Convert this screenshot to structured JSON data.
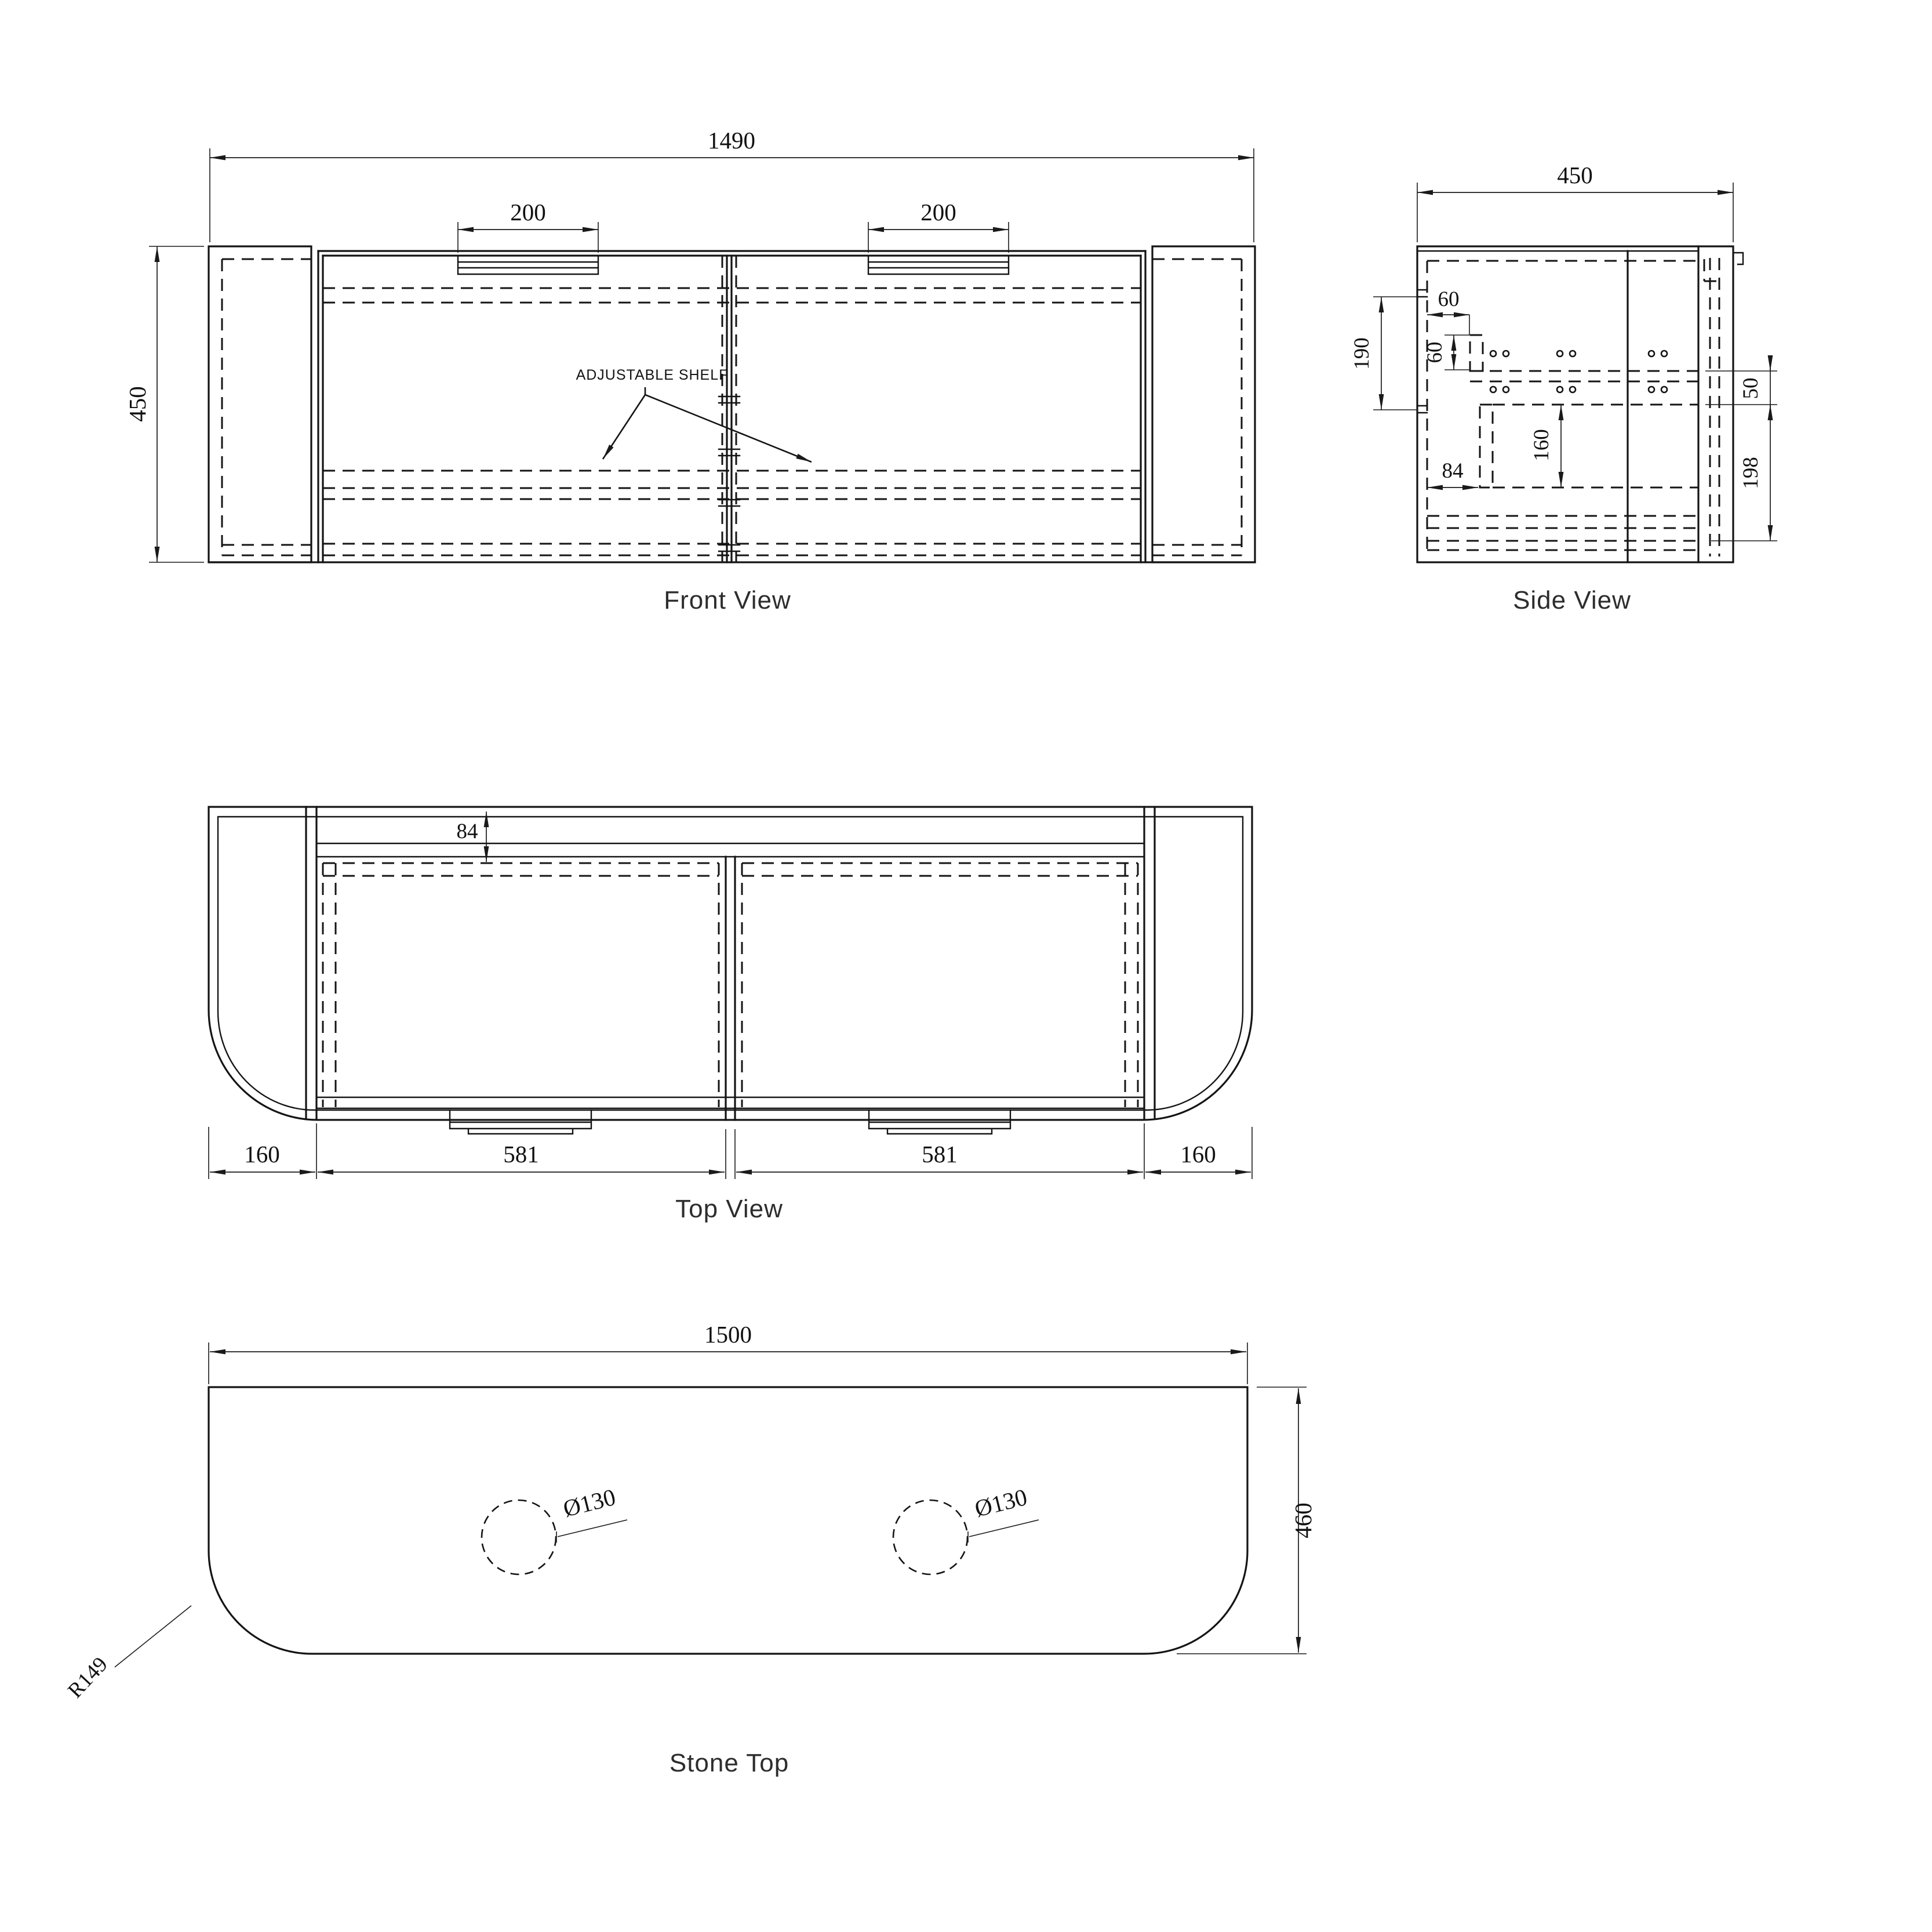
{
  "views": {
    "front": {
      "caption": "Front View",
      "shelf_label": "ADJUSTABLE SHELF",
      "dim_overall_width": "1490",
      "dim_overall_height": "450",
      "dim_handle_left": "200",
      "dim_handle_right": "200"
    },
    "side": {
      "caption": "Side View",
      "dim_overall_depth": "450",
      "dim_rail_spacing": "190",
      "dim_hinge_offset_h": "60",
      "dim_hinge_offset_v": "60",
      "dim_bracket_offset": "84",
      "dim_shelf_drop": "160",
      "dim_gap_small": "50",
      "dim_gap_bottom": "198"
    },
    "top": {
      "caption": "Top View",
      "dim_back_inset": "84",
      "dim_end_panel_left": "160",
      "dim_door_left": "581",
      "dim_door_right": "581",
      "dim_end_panel_right": "160"
    },
    "stone": {
      "caption": "Stone Top",
      "dim_width": "1500",
      "dim_depth": "460",
      "dim_tap_hole_left": "Ø130",
      "dim_tap_hole_right": "Ø130",
      "dim_corner_radius": "R149"
    }
  }
}
